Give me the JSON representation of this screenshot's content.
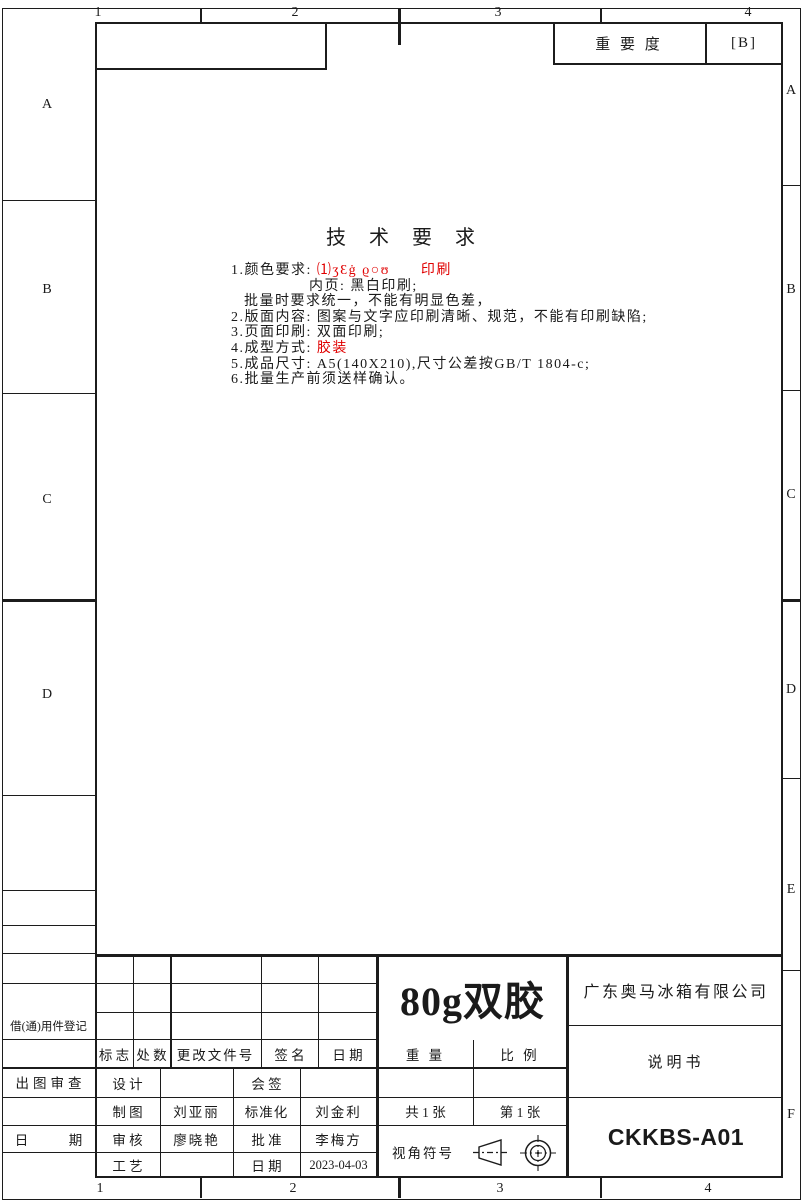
{
  "zones": {
    "top": [
      "1",
      "2",
      "3",
      "4"
    ],
    "bottom": [
      "1",
      "2",
      "3",
      "4"
    ],
    "left": [
      "A",
      "B",
      "C",
      "D"
    ],
    "right": [
      "A",
      "B",
      "C",
      "D",
      "E",
      "F"
    ]
  },
  "importance": {
    "label": "重 要 度",
    "value": "[B]"
  },
  "tech": {
    "title": "技 术 要 求",
    "line1_pre": "1.颜色要求: ",
    "line1_red": "⑴ʒƐġ ϱ○ʊ　　印刷",
    "line2": "内页: 黑白印刷;",
    "line3": "批量时要求统一，不能有明显色差，",
    "line4": "2.版面内容: 图案与文字应印刷清晰、规范，不能有印刷缺陷;",
    "line5": "3.页面印刷: 双面印刷;",
    "line6_pre": "4.成型方式: ",
    "line6_red": "胶装",
    "line7": "5.成品尺寸: A5(140X210),尺寸公差按GB/T 1804-c;",
    "line8": "6.批量生产前须送样确认。"
  },
  "left_panel": {
    "borrow_label": "借(通)用件登记",
    "plot_review": "出图审查",
    "date_label": "日　　　期"
  },
  "revision": {
    "headers": [
      "标 志",
      "处 数",
      "更改文件号",
      "签 名",
      "日 期"
    ]
  },
  "approval": {
    "design_label": "设 计",
    "draft_label": "制 图",
    "draft_value": "刘亚丽",
    "check_label": "审 核",
    "check_value": "廖晓艳",
    "process_label": "工 艺",
    "countersign_label": "会 签",
    "standard_label": "标准化",
    "standard_value": "刘金利",
    "approve_label": "批 准",
    "approve_value": "李梅方",
    "date_label": "日 期",
    "date_value": "2023-04-03"
  },
  "titleblock": {
    "material": "80g双胶",
    "weight_label": "重 量",
    "scale_label": "比 例",
    "sheets_total": "共 1 张",
    "sheet_current": "第 1 张",
    "view_symbol_label": "视角符号",
    "company": "广东奥马冰箱有限公司",
    "doc_type": "说明书",
    "doc_number": "CKKBS-A01"
  },
  "colors": {
    "line": "#1c1c1c",
    "red": "#e00000"
  }
}
